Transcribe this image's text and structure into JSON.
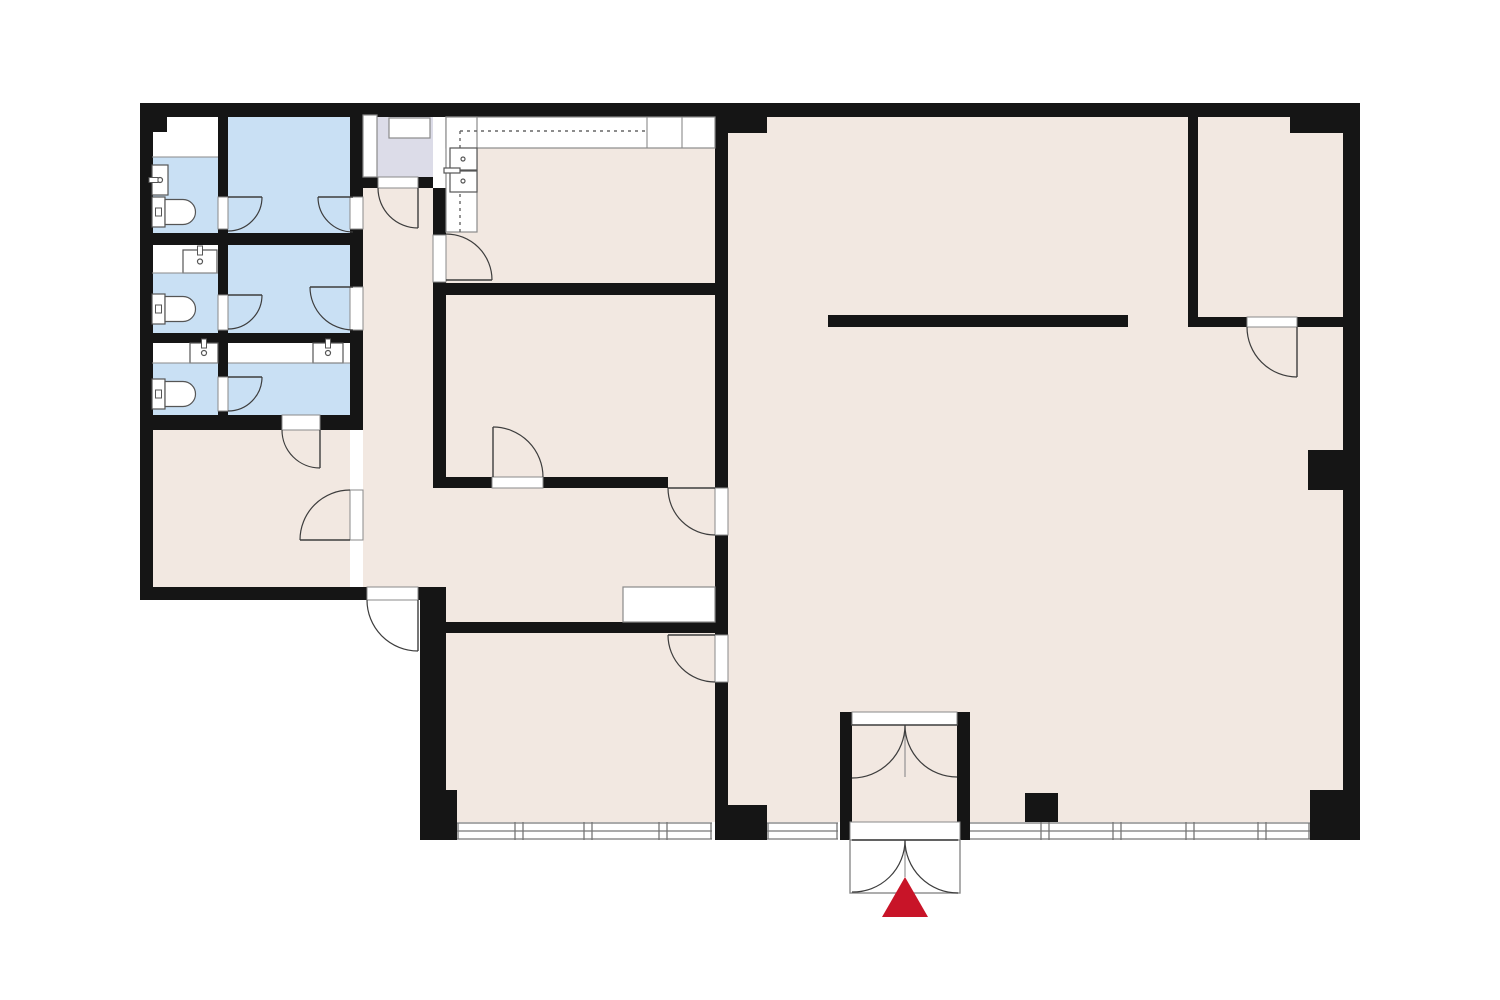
{
  "canvas": {
    "width": 1500,
    "height": 1000,
    "background": "#ffffff"
  },
  "palette": {
    "wall": "#151515",
    "beige": "#f2e8e1",
    "blue": "#c9e0f4",
    "lavender": "#dcdce8",
    "white": "#ffffff",
    "door": "#3d3d3d",
    "fixture": "#555555",
    "boxline": "#8a8a8a",
    "window": "#777777",
    "entrance_red": "#c81428"
  },
  "floors": [
    {
      "name": "floor-corridor",
      "color": "beige",
      "x": 363,
      "y": 188,
      "w": 70,
      "h": 399
    },
    {
      "name": "floor-hallway",
      "color": "beige",
      "x": 433,
      "y": 477,
      "w": 282,
      "h": 145
    },
    {
      "name": "floor-kitchen",
      "color": "beige",
      "x": 446,
      "y": 117,
      "w": 269,
      "h": 166
    },
    {
      "name": "floor-meeting-room",
      "color": "beige",
      "x": 446,
      "y": 295,
      "w": 269,
      "h": 182
    },
    {
      "name": "floor-lower-middle-room",
      "color": "beige",
      "x": 446,
      "y": 632,
      "w": 269,
      "h": 190
    },
    {
      "name": "floor-storage-room",
      "color": "beige",
      "x": 152,
      "y": 425,
      "w": 198,
      "h": 162
    },
    {
      "name": "floor-main-hall",
      "color": "beige",
      "x": 728,
      "y": 117,
      "w": 615,
      "h": 705
    },
    {
      "name": "floor-top-right-room",
      "color": "beige",
      "x": 1198,
      "y": 117,
      "w": 145,
      "h": 200
    },
    {
      "name": "floor-lavender-room",
      "color": "lavender",
      "x": 363,
      "y": 115,
      "w": 70,
      "h": 62
    },
    {
      "name": "floor-stall1-white",
      "color": "white",
      "x": 152,
      "y": 113,
      "w": 66,
      "h": 44
    },
    {
      "name": "floor-stall1-blue",
      "color": "blue",
      "x": 152,
      "y": 157,
      "w": 66,
      "h": 76
    },
    {
      "name": "floor-stall2-white",
      "color": "white",
      "x": 152,
      "y": 245,
      "w": 66,
      "h": 28
    },
    {
      "name": "floor-stall2-blue",
      "color": "blue",
      "x": 152,
      "y": 273,
      "w": 66,
      "h": 60
    },
    {
      "name": "floor-stall3-white",
      "color": "white",
      "x": 152,
      "y": 343,
      "w": 66,
      "h": 20
    },
    {
      "name": "floor-stall3-blue",
      "color": "blue",
      "x": 152,
      "y": 363,
      "w": 66,
      "h": 52
    },
    {
      "name": "floor-room-b-blue",
      "color": "blue",
      "x": 228,
      "y": 113,
      "w": 122,
      "h": 120
    },
    {
      "name": "floor-room-d-blue",
      "color": "blue",
      "x": 228,
      "y": 245,
      "w": 122,
      "h": 88
    },
    {
      "name": "floor-room-f-white",
      "color": "white",
      "x": 228,
      "y": 343,
      "w": 122,
      "h": 20
    },
    {
      "name": "floor-room-f-blue",
      "color": "blue",
      "x": 228,
      "y": 363,
      "w": 122,
      "h": 52
    }
  ],
  "windows": {
    "band": {
      "y_top": 822,
      "y_bottom": 840,
      "line_top": 823,
      "line_mid": 831,
      "line_bottom": 839
    },
    "segments": [
      {
        "name": "window-segment-left",
        "x1": 457,
        "x2": 712,
        "mullions": [
          519,
          588,
          663
        ]
      },
      {
        "name": "window-segment-center",
        "x1": 767,
        "x2": 838,
        "mullions": []
      },
      {
        "name": "window-segment-right",
        "x1": 968,
        "x2": 1310,
        "mullions": [
          1045,
          1117,
          1190,
          1262
        ]
      }
    ]
  },
  "walls": [
    {
      "name": "wall-exterior-top",
      "x": 140,
      "y": 103,
      "w": 1220,
      "h": 14
    },
    {
      "name": "wall-exterior-left",
      "x": 140,
      "y": 103,
      "w": 13,
      "h": 497
    },
    {
      "name": "wall-exterior-bottom-left",
      "x": 140,
      "y": 587,
      "w": 293,
      "h": 13
    },
    {
      "name": "wall-left-mid-vertical",
      "x": 420,
      "y": 587,
      "w": 26,
      "h": 205
    },
    {
      "name": "wall-corner-bottom-left",
      "x": 420,
      "y": 790,
      "w": 37,
      "h": 50
    },
    {
      "name": "wall-exterior-right",
      "x": 1343,
      "y": 103,
      "w": 17,
      "h": 737
    },
    {
      "name": "wall-corner-bottom-right",
      "x": 1310,
      "y": 790,
      "w": 50,
      "h": 50
    },
    {
      "name": "wall-bath-vertical-1",
      "x": 218,
      "y": 113,
      "w": 10,
      "h": 302
    },
    {
      "name": "wall-bath-vertical-2",
      "x": 350,
      "y": 103,
      "w": 13,
      "h": 312
    },
    {
      "name": "wall-bath-horizontal-1",
      "x": 152,
      "y": 233,
      "w": 211,
      "h": 12
    },
    {
      "name": "wall-bath-horizontal-2",
      "x": 152,
      "y": 333,
      "w": 211,
      "h": 10
    },
    {
      "name": "wall-bath-horizontal-3",
      "x": 140,
      "y": 415,
      "w": 223,
      "h": 15
    },
    {
      "name": "wall-lavender-bottom",
      "x": 363,
      "y": 177,
      "w": 70,
      "h": 11
    },
    {
      "name": "wall-corridor-right",
      "x": 433,
      "y": 188,
      "w": 13,
      "h": 289
    },
    {
      "name": "wall-kitchen-meeting",
      "x": 433,
      "y": 283,
      "w": 295,
      "h": 12
    },
    {
      "name": "wall-meeting-bottom",
      "x": 433,
      "y": 477,
      "w": 235,
      "h": 11
    },
    {
      "name": "wall-hallway-bottom",
      "x": 433,
      "y": 622,
      "w": 282,
      "h": 11
    },
    {
      "name": "wall-mid-vertical",
      "x": 715,
      "y": 103,
      "w": 13,
      "h": 737
    },
    {
      "name": "wall-top-junction-block",
      "x": 715,
      "y": 103,
      "w": 52,
      "h": 30
    },
    {
      "name": "wall-bottom-junction-block",
      "x": 717,
      "y": 805,
      "w": 50,
      "h": 35
    },
    {
      "name": "wall-top-right-room-left",
      "x": 1188,
      "y": 103,
      "w": 10,
      "h": 224
    },
    {
      "name": "wall-top-right-room-bottom-a",
      "x": 1188,
      "y": 317,
      "w": 59,
      "h": 10
    },
    {
      "name": "wall-top-right-room-bottom-b",
      "x": 1297,
      "y": 317,
      "w": 46,
      "h": 10
    },
    {
      "name": "wall-top-right-stub",
      "x": 1290,
      "y": 117,
      "w": 53,
      "h": 16
    },
    {
      "name": "wall-hall-freestanding-bar",
      "x": 828,
      "y": 315,
      "w": 300,
      "h": 12
    },
    {
      "name": "wall-hall-column",
      "x": 1025,
      "y": 793,
      "w": 33,
      "h": 29
    },
    {
      "name": "wall-right-pilaster",
      "x": 1308,
      "y": 450,
      "w": 35,
      "h": 40
    },
    {
      "name": "wall-step-top-left",
      "x": 150,
      "y": 113,
      "w": 17,
      "h": 19
    },
    {
      "name": "wall-vestibule-left-post",
      "x": 840,
      "y": 712,
      "w": 12,
      "h": 128
    },
    {
      "name": "wall-vestibule-right-post",
      "x": 957,
      "y": 712,
      "w": 13,
      "h": 128
    }
  ],
  "openings": [
    {
      "name": "opening-stall1-door",
      "x": 218,
      "y": 197,
      "w": 10,
      "h": 32
    },
    {
      "name": "opening-stall2-door",
      "x": 218,
      "y": 295,
      "w": 10,
      "h": 35
    },
    {
      "name": "opening-stall3-door",
      "x": 218,
      "y": 377,
      "w": 10,
      "h": 34
    },
    {
      "name": "opening-room-b-corridor",
      "x": 350,
      "y": 197,
      "w": 13,
      "h": 32
    },
    {
      "name": "opening-room-d-corridor",
      "x": 350,
      "y": 287,
      "w": 13,
      "h": 43
    },
    {
      "name": "opening-room-f-storage",
      "x": 282,
      "y": 415,
      "w": 38,
      "h": 15
    },
    {
      "name": "opening-storage-corridor",
      "x": 350,
      "y": 490,
      "w": 13,
      "h": 50
    },
    {
      "name": "opening-corridor-exit",
      "x": 367,
      "y": 587,
      "w": 51,
      "h": 13
    },
    {
      "name": "opening-lavender-room",
      "x": 378,
      "y": 177,
      "w": 40,
      "h": 11
    },
    {
      "name": "opening-kitchen-door",
      "x": 433,
      "y": 235,
      "w": 13,
      "h": 47
    },
    {
      "name": "opening-meeting-door",
      "x": 492,
      "y": 477,
      "w": 51,
      "h": 11
    },
    {
      "name": "opening-hallway-hall",
      "x": 715,
      "y": 488,
      "w": 13,
      "h": 47
    },
    {
      "name": "opening-hall-lower-room",
      "x": 715,
      "y": 635,
      "w": 13,
      "h": 47
    },
    {
      "name": "opening-top-right-room",
      "x": 1247,
      "y": 317,
      "w": 50,
      "h": 10
    },
    {
      "name": "opening-vestibule-top",
      "x": 852,
      "y": 712,
      "w": 105,
      "h": 13
    },
    {
      "name": "opening-vestibule-bottom",
      "x": 850,
      "y": 822,
      "w": 110,
      "h": 18
    }
  ],
  "fixtures": [
    {
      "type": "toilet",
      "name": "toilet-stall1",
      "x": 152,
      "y": 197
    },
    {
      "type": "toilet",
      "name": "toilet-stall2",
      "x": 152,
      "y": 294
    },
    {
      "type": "toilet",
      "name": "toilet-stall3",
      "x": 152,
      "y": 379
    },
    {
      "type": "sink",
      "name": "sink-stall1",
      "x": 152,
      "y": 165,
      "w": 16,
      "h": 30,
      "tap": "left"
    },
    {
      "type": "sink",
      "name": "sink-stall2",
      "x": 183,
      "y": 250,
      "w": 34,
      "h": 23,
      "tap": "top"
    },
    {
      "type": "sink",
      "name": "sink-stall3",
      "x": 190,
      "y": 343,
      "w": 28,
      "h": 20,
      "tap": "top"
    },
    {
      "type": "sink",
      "name": "sink-room-f",
      "x": 313,
      "y": 343,
      "w": 30,
      "h": 20,
      "tap": "top"
    },
    {
      "type": "counter",
      "name": "kitchen-counter-top",
      "x": 446,
      "y": 117,
      "w": 269,
      "h": 31
    },
    {
      "type": "counter",
      "name": "kitchen-counter-left",
      "x": 446,
      "y": 117,
      "w": 31,
      "h": 115
    },
    {
      "type": "line",
      "name": "kitchen-counter-divider-1",
      "x1": 647,
      "y1": 117,
      "x2": 647,
      "y2": 148
    },
    {
      "type": "line",
      "name": "kitchen-counter-divider-2",
      "x1": 682,
      "y1": 117,
      "x2": 682,
      "y2": 148
    },
    {
      "type": "dash",
      "name": "kitchen-overhead-cabinet-h",
      "x1": 460,
      "y1": 131,
      "x2": 645,
      "y2": 131
    },
    {
      "type": "dash",
      "name": "kitchen-overhead-cabinet-v",
      "x1": 460,
      "y1": 131,
      "x2": 460,
      "y2": 232
    },
    {
      "type": "ksink",
      "name": "kitchen-sink",
      "x": 450,
      "y": 148
    },
    {
      "type": "box",
      "name": "lavender-closet-strip",
      "x": 363,
      "y": 115,
      "w": 14,
      "h": 62
    },
    {
      "type": "box",
      "name": "lavender-shelf-box",
      "x": 389,
      "y": 118,
      "w": 41,
      "h": 20
    },
    {
      "type": "box",
      "name": "hallway-hatch-cabinet",
      "x": 623,
      "y": 587,
      "w": 92,
      "h": 35
    },
    {
      "type": "frame",
      "name": "entrance-outer-door-frame",
      "x": 850,
      "y": 840,
      "w": 110,
      "h": 53
    },
    {
      "type": "line",
      "name": "vestibule-inner-door-centerline",
      "x1": 905,
      "y1": 725,
      "x2": 905,
      "y2": 777
    },
    {
      "type": "line",
      "name": "entrance-outer-door-centerline",
      "x1": 905,
      "y1": 840,
      "x2": 905,
      "y2": 877
    },
    {
      "type": "line",
      "name": "stall1-strip-edge",
      "x1": 152,
      "y1": 157,
      "x2": 218,
      "y2": 157
    },
    {
      "type": "line",
      "name": "stall2-strip-edge",
      "x1": 152,
      "y1": 273,
      "x2": 218,
      "y2": 273
    },
    {
      "type": "line",
      "name": "stall3-strip-edge",
      "x1": 152,
      "y1": 363,
      "x2": 218,
      "y2": 363
    },
    {
      "type": "line",
      "name": "room-f-strip-edge",
      "x1": 228,
      "y1": 363,
      "x2": 350,
      "y2": 363
    },
    {
      "type": "triangle",
      "name": "entrance-arrow",
      "points": "905,877 882,917 928,917"
    }
  ],
  "doors": [
    {
      "name": "door-stall1",
      "hinge": [
        228,
        197
      ],
      "tip": [
        262,
        197
      ],
      "end": [
        228,
        231
      ],
      "r": 34,
      "sweep": 1
    },
    {
      "name": "door-stall2",
      "hinge": [
        228,
        295
      ],
      "tip": [
        262,
        295
      ],
      "end": [
        228,
        329
      ],
      "r": 34,
      "sweep": 1
    },
    {
      "name": "door-stall3",
      "hinge": [
        228,
        377
      ],
      "tip": [
        262,
        377
      ],
      "end": [
        228,
        411
      ],
      "r": 34,
      "sweep": 1
    },
    {
      "name": "door-room-b-corridor",
      "hinge": [
        353,
        197
      ],
      "tip": [
        318,
        197
      ],
      "end": [
        353,
        232
      ],
      "r": 35,
      "sweep": 0
    },
    {
      "name": "door-room-d-corridor",
      "hinge": [
        353,
        287
      ],
      "tip": [
        310,
        287
      ],
      "end": [
        353,
        330
      ],
      "r": 43,
      "sweep": 0
    },
    {
      "name": "door-room-f-storage",
      "hinge": [
        320,
        430
      ],
      "tip": [
        320,
        468
      ],
      "end": [
        282,
        430
      ],
      "r": 38,
      "sweep": 1
    },
    {
      "name": "door-storage-corridor",
      "hinge": [
        350,
        540
      ],
      "tip": [
        300,
        540
      ],
      "end": [
        350,
        490
      ],
      "r": 50,
      "sweep": 1
    },
    {
      "name": "door-corridor-exit",
      "hinge": [
        418,
        600
      ],
      "tip": [
        418,
        651
      ],
      "end": [
        367,
        600
      ],
      "r": 51,
      "sweep": 1
    },
    {
      "name": "door-lavender-room",
      "hinge": [
        418,
        188
      ],
      "tip": [
        418,
        228
      ],
      "end": [
        378,
        188
      ],
      "r": 40,
      "sweep": 1
    },
    {
      "name": "door-kitchen",
      "hinge": [
        446,
        280
      ],
      "tip": [
        492,
        280
      ],
      "end": [
        446,
        234
      ],
      "r": 46,
      "sweep": 0
    },
    {
      "name": "door-meeting-room",
      "hinge": [
        493,
        477
      ],
      "tip": [
        493,
        427
      ],
      "end": [
        543,
        477
      ],
      "r": 50,
      "sweep": 1
    },
    {
      "name": "door-hallway-hall",
      "hinge": [
        715,
        488
      ],
      "tip": [
        668,
        488
      ],
      "end": [
        715,
        535
      ],
      "r": 47,
      "sweep": 0
    },
    {
      "name": "door-hall-lower-room",
      "hinge": [
        715,
        635
      ],
      "tip": [
        668,
        635
      ],
      "end": [
        715,
        682
      ],
      "r": 47,
      "sweep": 0
    },
    {
      "name": "door-top-right-room",
      "hinge": [
        1297,
        327
      ],
      "tip": [
        1297,
        377
      ],
      "end": [
        1247,
        327
      ],
      "r": 50,
      "sweep": 1
    },
    {
      "name": "door-vestibule-inner-left",
      "hinge": [
        852,
        725
      ],
      "tip": [
        905,
        725
      ],
      "end": [
        852,
        778
      ],
      "r": 53,
      "sweep": 1
    },
    {
      "name": "door-vestibule-inner-right",
      "hinge": [
        957,
        725
      ],
      "tip": [
        905,
        725
      ],
      "end": [
        957,
        777
      ],
      "r": 52,
      "sweep": 0
    },
    {
      "name": "door-entrance-outer-left",
      "hinge": [
        852,
        840
      ],
      "tip": [
        905,
        840
      ],
      "end": [
        852,
        892
      ],
      "r": 52,
      "sweep": 1
    },
    {
      "name": "door-entrance-outer-right",
      "hinge": [
        958,
        840
      ],
      "tip": [
        905,
        840
      ],
      "end": [
        958,
        893
      ],
      "r": 53,
      "sweep": 0
    }
  ]
}
